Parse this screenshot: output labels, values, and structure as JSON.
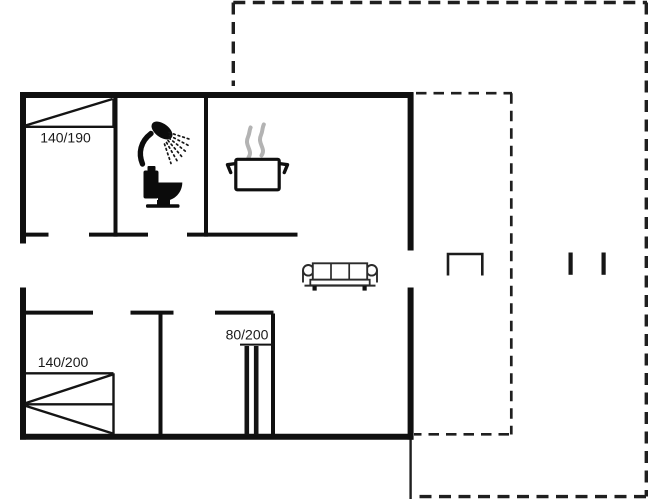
{
  "floorplan": {
    "type": "holiday-home-floor-plan",
    "labels": {
      "bed_top_left": "140/190",
      "bed_bottom_left": "140/200",
      "bed_bottom_middle": "80/200"
    },
    "icons": [
      {
        "name": "shower-icon",
        "meaning": "bathroom shower head with spray"
      },
      {
        "name": "toilet-icon",
        "meaning": "toilet silhouette"
      },
      {
        "name": "cooking-pot-icon",
        "meaning": "kitchen stove pot"
      },
      {
        "name": "steam-icon",
        "meaning": "steam rising from pot"
      },
      {
        "name": "sofa-icon",
        "meaning": "three-seat sofa in living room"
      },
      {
        "name": "armchair-icon",
        "meaning": "outdoor furniture on terrace"
      },
      {
        "name": "terrace-post-icon",
        "meaning": "terrace post marks"
      }
    ],
    "colors": {
      "background": "#ffffff",
      "line": "#141414",
      "steam": "#b3b3b3"
    }
  }
}
